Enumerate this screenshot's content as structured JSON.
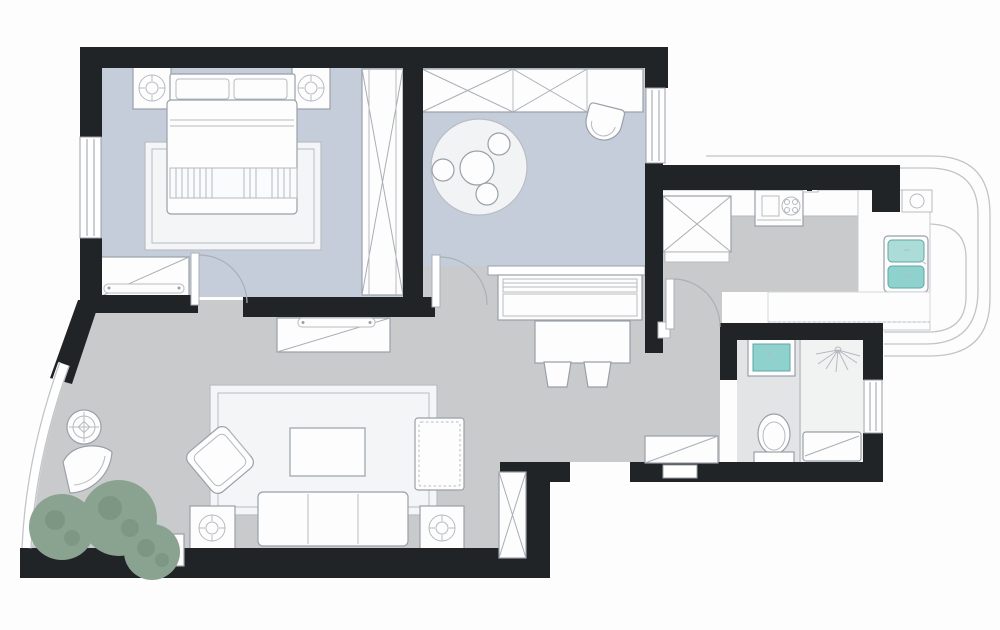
{
  "meta": {
    "type": "floor-plan",
    "description": "Top-down furnished apartment floor plan with black walls, blue-gray bedroom and study floors, gray living-dining floor, kitchen with curved bay window, bathroom, and curved glass living-room wall with plants"
  },
  "palette": {
    "wall": "#212427",
    "floor_bedroom": "#c5cdda",
    "floor_study": "#c5cdda",
    "floor_living": "#c9cacc",
    "floor_kitchen": "#c9cacc",
    "floor_bath": "#e3e4e6",
    "floor_shower": "#f1f2f2",
    "rug": "#f4f5f7",
    "round_rug": "#f2f3f5",
    "sink_teal": "#8ed1cd",
    "sink_teal_light": "#abdcd8",
    "plant": "#8aa390",
    "plant_dark": "#718c79",
    "glass": "#c2c4c6",
    "furniture_stroke": "#9aa0a8"
  },
  "rooms": [
    {
      "id": "bedroom",
      "position": "top-left"
    },
    {
      "id": "study",
      "position": "top-middle"
    },
    {
      "id": "living-dining",
      "position": "bottom-left"
    },
    {
      "id": "kitchen",
      "position": "top-right"
    },
    {
      "id": "bathroom",
      "position": "middle-right"
    },
    {
      "id": "entry-hallway",
      "position": "bottom-middle"
    },
    {
      "id": "bay-balcony",
      "position": "right"
    }
  ],
  "furniture": {
    "bedroom": [
      "double-bed",
      "pillows",
      "left-nightstand-lamp",
      "right-nightstand-lamp",
      "area-rug",
      "x-wardrobe",
      "dresser-tv"
    ],
    "study": [
      "closet-band",
      "round-rug",
      "round-table",
      "three-stools",
      "tub-chair"
    ],
    "dining": [
      "console-piano",
      "dining-table",
      "two-stools"
    ],
    "living": [
      "tv-cabinet",
      "large-rug",
      "coffee-table",
      "three-seat-sofa",
      "left-lamp-table",
      "right-lamp-table",
      "ottoman",
      "rotated-armchair",
      "fan-chair",
      "round-lamp-table",
      "plants",
      "plant-pot"
    ],
    "kitchen": [
      "x-fridge-cabinet",
      "counter",
      "stove-cooktop",
      "double-sink",
      "lower-sill",
      "water-heater"
    ],
    "bathroom": [
      "vanity-sink",
      "toilet",
      "shower-head",
      "shower-tray"
    ],
    "entry": [
      "x-storage-cabinet",
      "shoe-cabinet"
    ]
  }
}
